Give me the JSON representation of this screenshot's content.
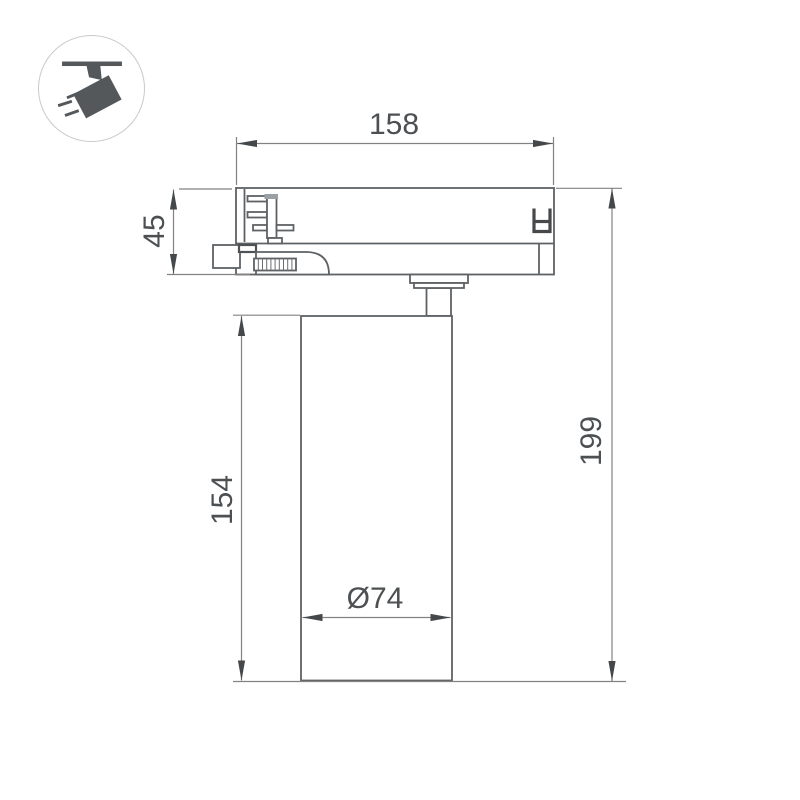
{
  "icon": {
    "name": "ceiling-track-spotlight",
    "circle_border_color": "#c9c9c9",
    "glyph_color": "#54585b"
  },
  "drawing": {
    "outline_color": "#5f6265",
    "dim_line_color": "#828282",
    "arrow_color": "#44484a",
    "text_color": "#4c5052",
    "dimensions": {
      "width": "158",
      "adapter_height": "45",
      "body_height": "154",
      "total_height": "199",
      "diameter": "Ø74"
    }
  }
}
